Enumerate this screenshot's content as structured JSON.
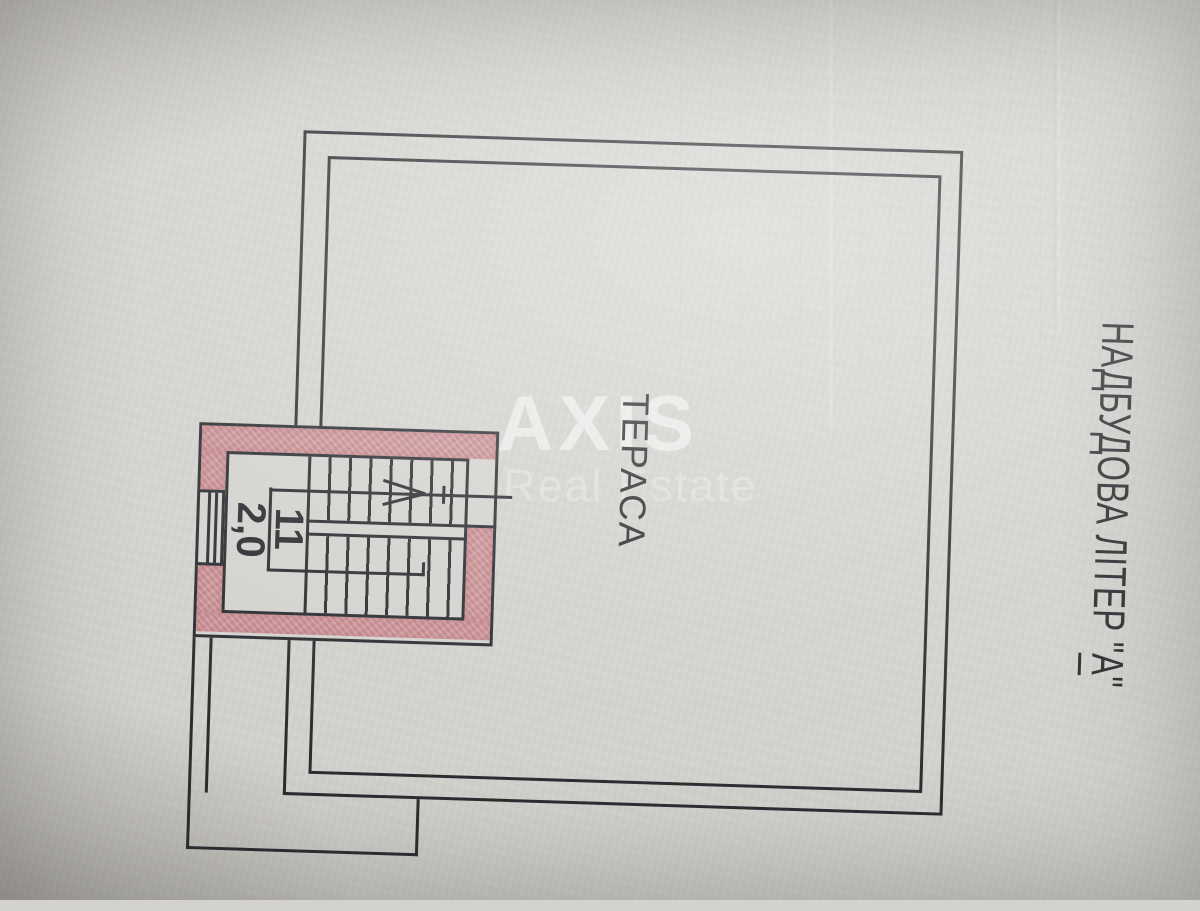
{
  "document": {
    "plan": {
      "terrace_label": "ТЕРАСА",
      "room": {
        "number": "11",
        "area": "2,0"
      }
    },
    "building_label": {
      "prefix": "НАДБУДОВА ЛІТЕР \"",
      "letter": "А",
      "suffix": "\""
    },
    "watermark": {
      "brand": "AXIS",
      "tagline": "Real Estate"
    },
    "colors": {
      "paper": "#d3d2ce",
      "line": "#2b2d31",
      "wall_fill": "#c06a72",
      "ink": "#2b2d30"
    }
  }
}
